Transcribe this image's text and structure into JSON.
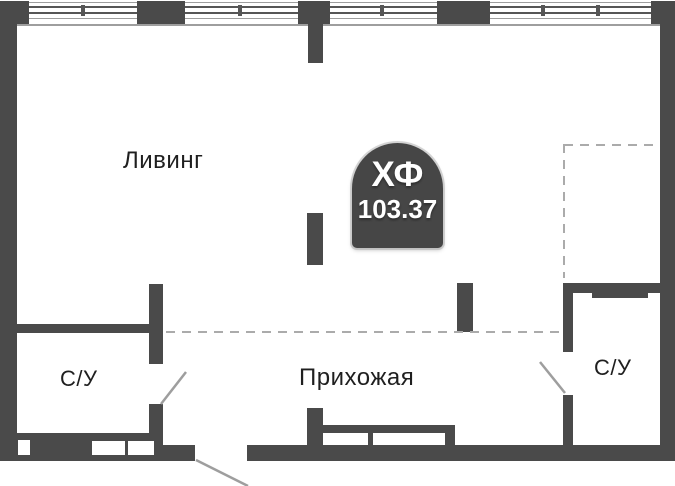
{
  "plan": {
    "title": "Floor plan",
    "rooms": [
      {
        "id": "living",
        "label": "Ливинг"
      },
      {
        "id": "hallway",
        "label": "Прихожая"
      },
      {
        "id": "bathroom-left",
        "label": "С/У"
      },
      {
        "id": "bathroom-right",
        "label": "С/У"
      }
    ],
    "badge": {
      "title": "ХФ",
      "area": "103.37"
    }
  },
  "colors": {
    "wall": "#4A4A4A",
    "glaze": "#565656",
    "line": "#9E9E9E",
    "dash": "#ABABAB",
    "text": "#1F1F1F",
    "badge_bg": "#464646",
    "badge_text": "#FFFFFF",
    "bg": "#FFFFFF"
  }
}
